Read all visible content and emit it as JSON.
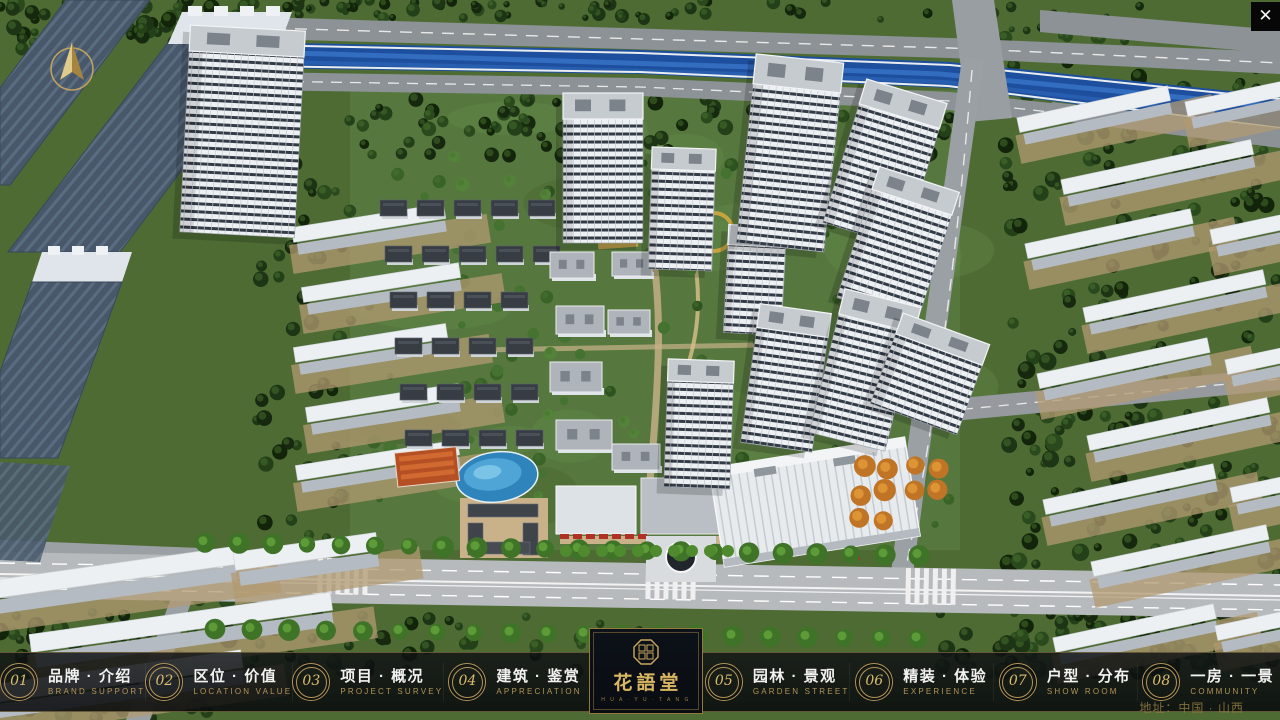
{
  "header": {
    "close_label": "✕"
  },
  "logo": {
    "title": "花語堂",
    "subtitle": "H U A · Y U · T A N G"
  },
  "nav": {
    "items": [
      {
        "num": "01",
        "label": "品牌 · 介绍",
        "sublabel": "BRAND SUPPORT"
      },
      {
        "num": "02",
        "label": "区位 · 价值",
        "sublabel": "LOCATION VALUE"
      },
      {
        "num": "03",
        "label": "项目 · 概况",
        "sublabel": "PROJECT SURVEY"
      },
      {
        "num": "04",
        "label": "建筑 · 鉴赏",
        "sublabel": "APPRECIATION"
      },
      {
        "num": "05",
        "label": "园林 · 景观",
        "sublabel": "GARDEN STREET"
      },
      {
        "num": "06",
        "label": "精装 · 体验",
        "sublabel": "EXPERIENCE"
      },
      {
        "num": "07",
        "label": "户型 · 分布",
        "sublabel": "SHOW ROOM"
      },
      {
        "num": "08",
        "label": "一房 · 一景",
        "sublabel": "COMMUNITY"
      }
    ]
  },
  "footer": {
    "address": "地址：中国 · 山西"
  },
  "colors": {
    "accent_gold": "#c9a85f",
    "bar_background": "rgba(10,12,14,0.85)",
    "river_blue": "#1d4f9e",
    "grass_green": "#4e6b34",
    "road_gray": "#9aa0a4"
  }
}
